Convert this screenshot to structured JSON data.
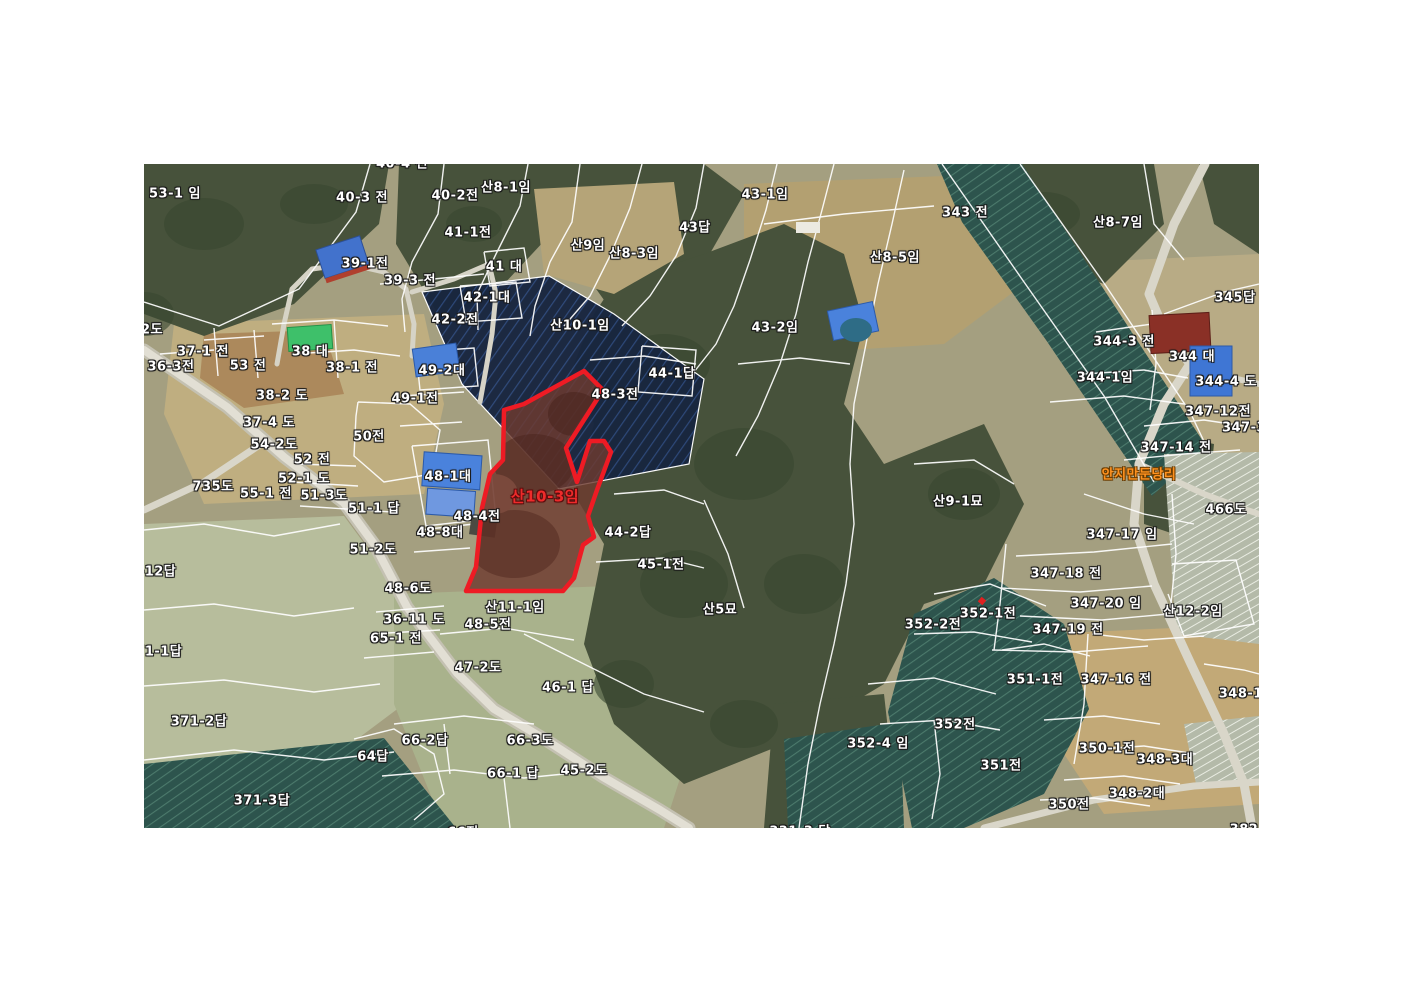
{
  "map": {
    "type": "cadastral-aerial-map",
    "colors": {
      "boundary_line": "#ffffff",
      "highlight_outline": "#ee1b24",
      "highlight_label_color": "#ee2b2b",
      "village_label_color": "#ff9220"
    },
    "highlighted_parcel": {
      "label": "산10-3임"
    },
    "village_label": {
      "text": "안지만둔당리"
    },
    "labels": [
      {
        "text": "53-1 임",
        "x": 31,
        "y": 28
      },
      {
        "text": "40-4 전",
        "x": 258,
        "y": -2
      },
      {
        "text": "40-3 전",
        "x": 218,
        "y": 32
      },
      {
        "text": "40-2전",
        "x": 311,
        "y": 30
      },
      {
        "text": "산8-1임",
        "x": 362,
        "y": 22
      },
      {
        "text": "41-1전",
        "x": 324,
        "y": 67
      },
      {
        "text": "39-1전",
        "x": 221,
        "y": 98
      },
      {
        "text": "39-3 전",
        "x": 266,
        "y": 115
      },
      {
        "text": "41 대",
        "x": 360,
        "y": 101
      },
      {
        "text": "42-1대",
        "x": 343,
        "y": 132
      },
      {
        "text": "42-2전",
        "x": 311,
        "y": 154
      },
      {
        "text": "산9임",
        "x": 444,
        "y": 80
      },
      {
        "text": "산8-3임",
        "x": 490,
        "y": 88
      },
      {
        "text": "43답",
        "x": 551,
        "y": 62
      },
      {
        "text": "43-1임",
        "x": 621,
        "y": 29
      },
      {
        "text": "산10-1임",
        "x": 436,
        "y": 160
      },
      {
        "text": "43-2임",
        "x": 631,
        "y": 162
      },
      {
        "text": "343 전",
        "x": 821,
        "y": 47
      },
      {
        "text": "산8-5임",
        "x": 751,
        "y": 92
      },
      {
        "text": "산8-7임",
        "x": 974,
        "y": 57
      },
      {
        "text": "344-3 전",
        "x": 980,
        "y": 176
      },
      {
        "text": "345답",
        "x": 1091,
        "y": 132
      },
      {
        "text": "344 대",
        "x": 1048,
        "y": 191
      },
      {
        "text": "344-1임",
        "x": 961,
        "y": 212
      },
      {
        "text": "344-4 도",
        "x": 1082,
        "y": 216
      },
      {
        "text": "347-12전",
        "x": 1074,
        "y": 246
      },
      {
        "text": "347-3",
        "x": 1100,
        "y": 264
      },
      {
        "text": "347-14 전",
        "x": 1032,
        "y": 282
      },
      {
        "text": "2도",
        "x": 8,
        "y": 164
      },
      {
        "text": "37-1 전",
        "x": 59,
        "y": 186
      },
      {
        "text": "36-3전",
        "x": 27,
        "y": 201
      },
      {
        "text": "53 전",
        "x": 104,
        "y": 200
      },
      {
        "text": "38 대",
        "x": 166,
        "y": 186
      },
      {
        "text": "38-1 전",
        "x": 208,
        "y": 202
      },
      {
        "text": "38-2 도",
        "x": 138,
        "y": 230
      },
      {
        "text": "37-4 도",
        "x": 125,
        "y": 257
      },
      {
        "text": "54-2도",
        "x": 130,
        "y": 279
      },
      {
        "text": "52 전",
        "x": 168,
        "y": 294
      },
      {
        "text": "52-1 도",
        "x": 160,
        "y": 313
      },
      {
        "text": "735도",
        "x": 69,
        "y": 321
      },
      {
        "text": "55-1 전",
        "x": 122,
        "y": 328
      },
      {
        "text": "51-3도",
        "x": 180,
        "y": 330
      },
      {
        "text": "51-1 답",
        "x": 230,
        "y": 343
      },
      {
        "text": "50전",
        "x": 225,
        "y": 271
      },
      {
        "text": "49-1전",
        "x": 271,
        "y": 233
      },
      {
        "text": "49-2대",
        "x": 298,
        "y": 205
      },
      {
        "text": "48-1대",
        "x": 304,
        "y": 311
      },
      {
        "text": "48-4전",
        "x": 333,
        "y": 351
      },
      {
        "text": "48-8대",
        "x": 296,
        "y": 367
      },
      {
        "text": "44-1답",
        "x": 528,
        "y": 208
      },
      {
        "text": "48-3전",
        "x": 471,
        "y": 229
      },
      {
        "text": "산10-3임",
        "x": 401,
        "y": 332,
        "variant": "red"
      },
      {
        "text": "44-2답",
        "x": 484,
        "y": 367
      },
      {
        "text": "45-1전",
        "x": 517,
        "y": 399
      },
      {
        "text": "51-2도",
        "x": 229,
        "y": 384
      },
      {
        "text": "48-6도",
        "x": 264,
        "y": 423
      },
      {
        "text": "36-11 도",
        "x": 270,
        "y": 454
      },
      {
        "text": "65-1 전",
        "x": 252,
        "y": 473
      },
      {
        "text": "산11-1임",
        "x": 371,
        "y": 442
      },
      {
        "text": "48-5전",
        "x": 344,
        "y": 459
      },
      {
        "text": "47-2도",
        "x": 334,
        "y": 502
      },
      {
        "text": "46-1 답",
        "x": 424,
        "y": 522
      },
      {
        "text": "37-12답",
        "x": 4,
        "y": 406
      },
      {
        "text": "371-1답",
        "x": 10,
        "y": 486
      },
      {
        "text": "371-2답",
        "x": 55,
        "y": 556
      },
      {
        "text": "371-3답",
        "x": 118,
        "y": 635
      },
      {
        "text": "64답",
        "x": 229,
        "y": 591
      },
      {
        "text": "66-2답",
        "x": 281,
        "y": 575
      },
      {
        "text": "66-3도",
        "x": 386,
        "y": 575
      },
      {
        "text": "66-1 답",
        "x": 369,
        "y": 608
      },
      {
        "text": "45-2도",
        "x": 440,
        "y": 605
      },
      {
        "text": "66전",
        "x": 319,
        "y": 667
      },
      {
        "text": "331-3 답",
        "x": 656,
        "y": 666
      },
      {
        "text": "산5묘",
        "x": 576,
        "y": 444
      },
      {
        "text": "산9-1묘",
        "x": 814,
        "y": 336
      },
      {
        "text": "안지만둔당리",
        "x": 995,
        "y": 309,
        "variant": "orange"
      },
      {
        "text": "347-17 임",
        "x": 978,
        "y": 369
      },
      {
        "text": "466도",
        "x": 1082,
        "y": 344
      },
      {
        "text": "347-18 전",
        "x": 922,
        "y": 408
      },
      {
        "text": "347-20 임",
        "x": 962,
        "y": 438
      },
      {
        "text": "347-19 전",
        "x": 924,
        "y": 464
      },
      {
        "text": "산12-2임",
        "x": 1049,
        "y": 446
      },
      {
        "text": "352-1전",
        "x": 844,
        "y": 448
      },
      {
        "text": "352-2전",
        "x": 789,
        "y": 459
      },
      {
        "text": "352-4 임",
        "x": 734,
        "y": 578
      },
      {
        "text": "352전",
        "x": 811,
        "y": 559
      },
      {
        "text": "351-1전",
        "x": 891,
        "y": 514
      },
      {
        "text": "347-16 전",
        "x": 972,
        "y": 514
      },
      {
        "text": "348-1전",
        "x": 1103,
        "y": 528
      },
      {
        "text": "350-1전",
        "x": 963,
        "y": 583
      },
      {
        "text": "348-3대",
        "x": 1021,
        "y": 594
      },
      {
        "text": "351전",
        "x": 857,
        "y": 600
      },
      {
        "text": "348-2대",
        "x": 993,
        "y": 628
      },
      {
        "text": "350전",
        "x": 925,
        "y": 639
      },
      {
        "text": "382",
        "x": 1100,
        "y": 666
      }
    ]
  }
}
